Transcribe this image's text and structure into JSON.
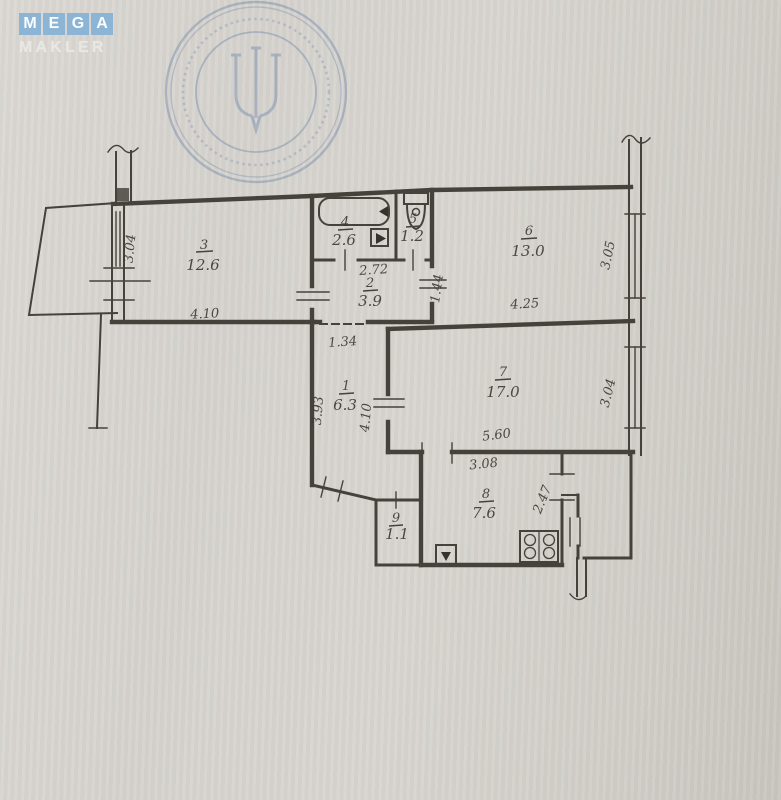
{
  "watermark": {
    "letters": [
      "M",
      "E",
      "G",
      "A"
    ],
    "subtitle": "MAKLER",
    "box_color": "#8cb4d4"
  },
  "stamp": {
    "description": "round-blue-ink-stamp-with-trident",
    "color": "#51739f"
  },
  "plan": {
    "rooms": {
      "r1": {
        "number": "1",
        "area": "6.3"
      },
      "r2": {
        "number": "2",
        "area": "3.9"
      },
      "r3": {
        "number": "3",
        "area": "12.6"
      },
      "r4": {
        "number": "4",
        "area": "2.6"
      },
      "r5": {
        "number": "5",
        "area": "1.2"
      },
      "r6": {
        "number": "6",
        "area": "13.0"
      },
      "r7": {
        "number": "7",
        "area": "17.0"
      },
      "r8": {
        "number": "8",
        "area": "7.6"
      },
      "r9": {
        "number": "9",
        "area": "1.1"
      }
    },
    "dims": {
      "room3_width": "4.10",
      "room3_depth": "3.04",
      "sanitary_width": "2.72",
      "room2_depth": "1.44",
      "hall_opening": "1.34",
      "hall_depth": "3.93",
      "hall_length": "4.10",
      "room6_width": "4.25",
      "room6_depth": "3.05",
      "room7_width": "5.60",
      "room7_depth": "3.04",
      "kitchen_width": "3.08",
      "kitchen_depth": "2.47"
    }
  }
}
